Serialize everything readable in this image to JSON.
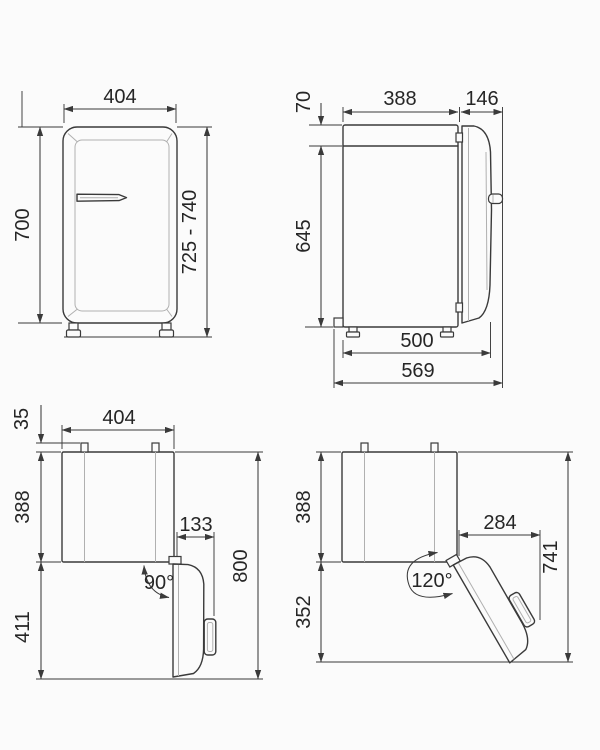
{
  "diagram_title": "refrigerator-installation-dimensions",
  "units_note": "",
  "views": {
    "front": {
      "width": "404",
      "body_height": "700",
      "total_height": "725 - 740"
    },
    "side": {
      "top_offset": "70",
      "body_depth": "388",
      "door_depth": "146",
      "body_height": "645",
      "depth_to_door_front": "500",
      "total_depth": "569"
    },
    "top_open_90": {
      "hinge_offset": "35",
      "width": "404",
      "body_depth": "388",
      "door_projection": "133",
      "door_swing_depth": "411",
      "total_clearance": "800",
      "opening_angle": "90°"
    },
    "top_open_120": {
      "body_depth": "388",
      "door_projection": "284",
      "door_swing_depth": "352",
      "total_clearance": "741",
      "opening_angle": "120°"
    }
  },
  "colors": {
    "line": "#3a3a3a",
    "light_line": "#b0b0b0",
    "text": "#262626",
    "background": "#fbfbfb"
  }
}
